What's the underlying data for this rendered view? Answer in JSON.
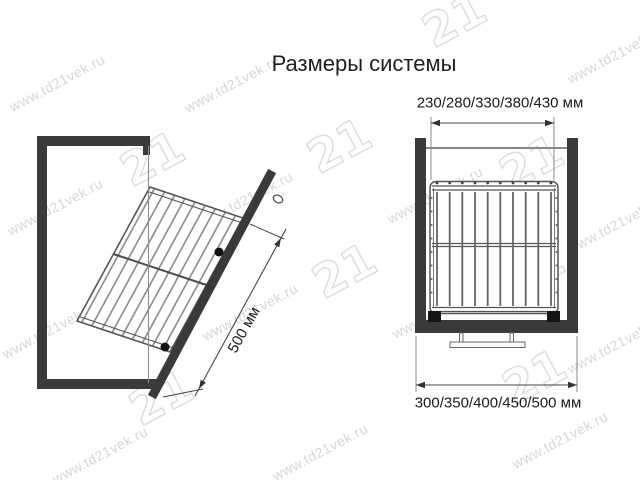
{
  "title": "Размеры системы",
  "watermark": {
    "text": "www.td21vek.ru",
    "logo": "21"
  },
  "dimensions": {
    "door_length": "500 мм",
    "basket_width": "230/280/330/380/430 мм",
    "cabinet_width": "300/350/400/450/500 мм"
  },
  "colors": {
    "ink_dark": "#3a3a3a",
    "line_mid": "#555555",
    "dimension_line": "#444444",
    "watermark_gray": "#c4c4c4"
  }
}
